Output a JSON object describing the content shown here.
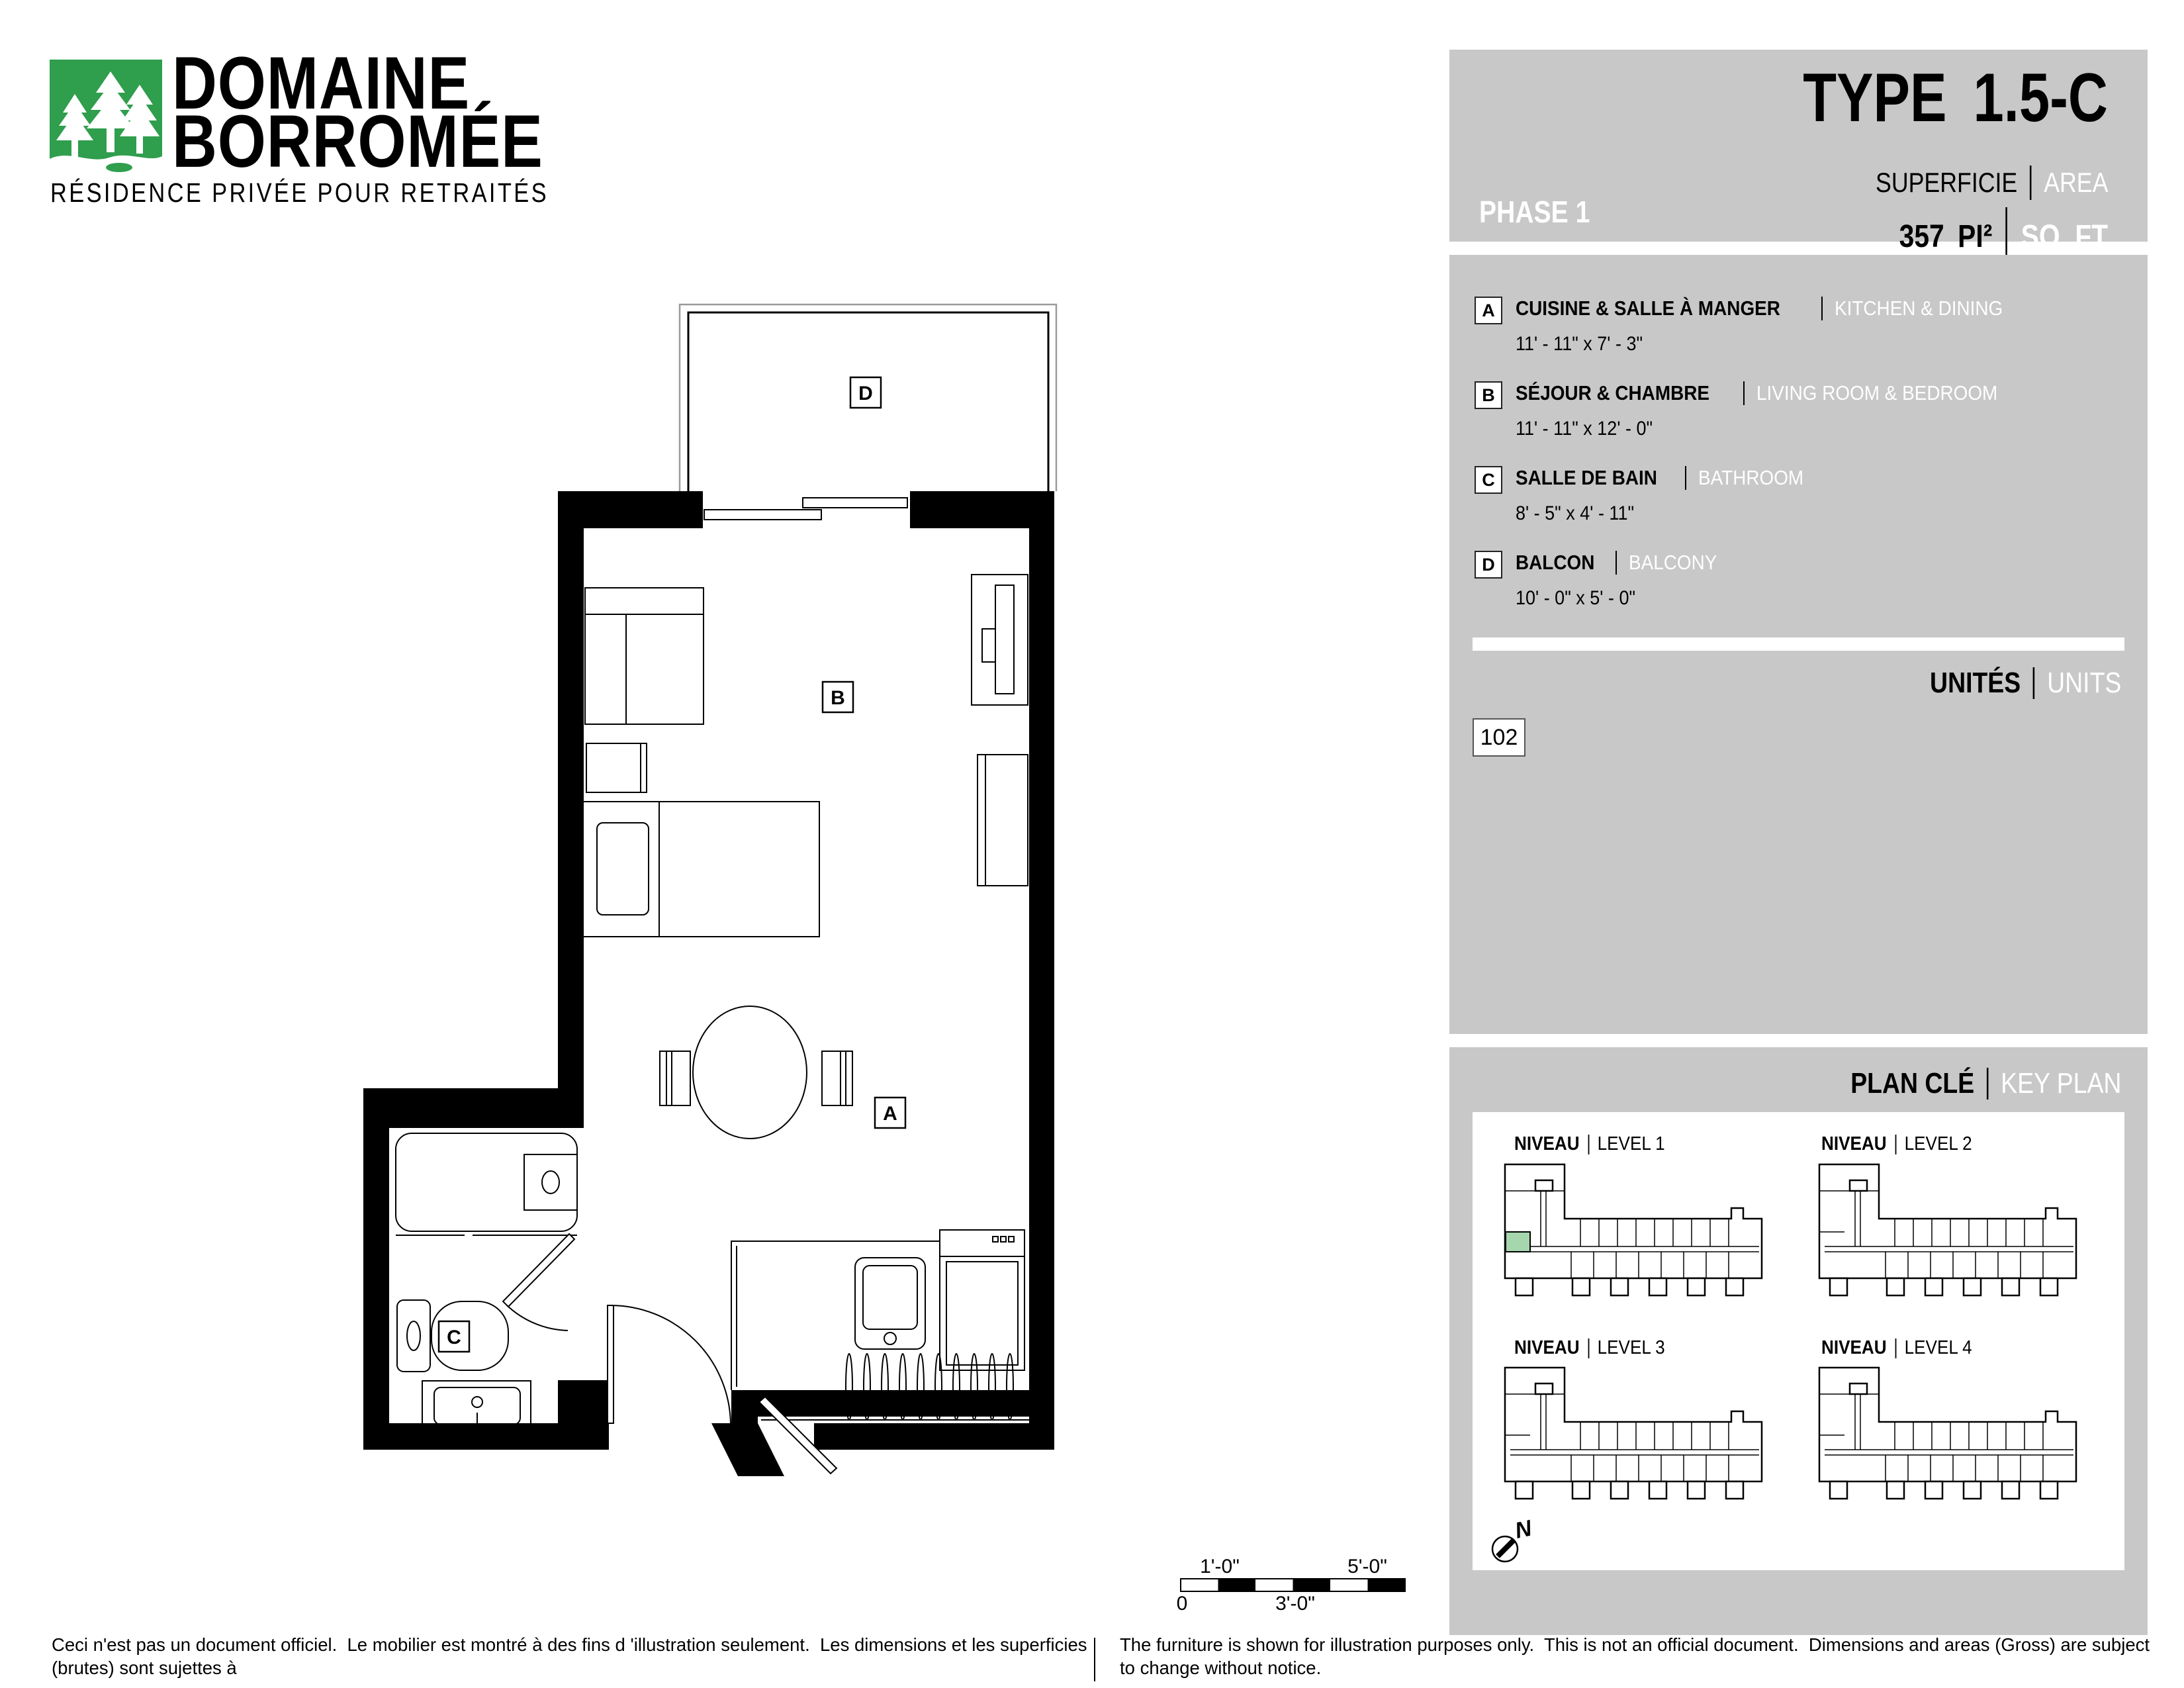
{
  "logo": {
    "name_line1": "DOMAINE",
    "name_line2": "BORROMÉE",
    "tagline": "RÉSIDENCE PRIVÉE POUR RETRAITÉS"
  },
  "header": {
    "phase": "PHASE 1",
    "type_label": "TYPE",
    "type_value": "1.5-C",
    "superficie_label": "SUPERFICIE",
    "area_label": "AREA",
    "area_value": "357",
    "area_unit_fr": "PI²",
    "area_unit_en": "SQ. FT"
  },
  "legend": {
    "items": [
      {
        "letter": "A",
        "name_fr": "CUISINE & SALLE À MANGER",
        "name_en": "KITCHEN & DINING",
        "dims": "11' - 11\" x 7' - 3\""
      },
      {
        "letter": "B",
        "name_fr": "SÉJOUR & CHAMBRE",
        "name_en": "LIVING ROOM & BEDROOM",
        "dims": "11' - 11\" x 12' - 0\""
      },
      {
        "letter": "C",
        "name_fr": "SALLE DE BAIN",
        "name_en": "BATHROOM",
        "dims": "8' - 5\" x 4' - 11\""
      },
      {
        "letter": "D",
        "name_fr": "BALCON",
        "name_en": "BALCONY",
        "dims": "10' - 0\" x 5' - 0\""
      }
    ]
  },
  "units": {
    "title_fr": "UNITÉS",
    "title_en": "UNITS",
    "numbers": [
      "102"
    ]
  },
  "key_plan": {
    "title_fr": "PLAN CLÉ",
    "title_en": "KEY PLAN",
    "levels": [
      {
        "label_fr": "NIVEAU",
        "label_en": "LEVEL 1",
        "highlighted": true
      },
      {
        "label_fr": "NIVEAU",
        "label_en": "LEVEL 2",
        "highlighted": false
      },
      {
        "label_fr": "NIVEAU",
        "label_en": "LEVEL 3",
        "highlighted": false
      },
      {
        "label_fr": "NIVEAU",
        "label_en": "LEVEL 4",
        "highlighted": false
      }
    ],
    "compass_label": "N"
  },
  "floor_plan": {
    "room_labels": {
      "a": "A",
      "b": "B",
      "c": "C",
      "d": "D"
    }
  },
  "scale_bar": {
    "top_left": "1'-0\"",
    "top_right": "5'-0\"",
    "bottom_left": "0",
    "bottom_mid": "3'-0\""
  },
  "footer": {
    "fr_line1": "Ceci n'est pas un document officiel.  Le mobilier est montré à des fins d 'illustration seulement.  Les dimensions et les superficies (brutes) sont sujettes à",
    "fr_line2": "changement sans préavis. La superficie et la position des éléments structuraux peuvent varier en fonction de l'emplacement de l'unité dans le bâtiment.",
    "en_line1": "The furniture is shown for illustration purposes only.  This is not an official document.  Dimensions and areas (Gross) are subject to change without notice.",
    "en_line2": "Area and position of structural elements may vary depending of location of unit in building."
  },
  "colors": {
    "panel_gray": "#c8c8c8",
    "logo_green": "#2f9e4d",
    "highlight_green": "#a5d6ae",
    "black": "#000000",
    "white": "#ffffff",
    "balcony_line": "#9a9a9a"
  }
}
